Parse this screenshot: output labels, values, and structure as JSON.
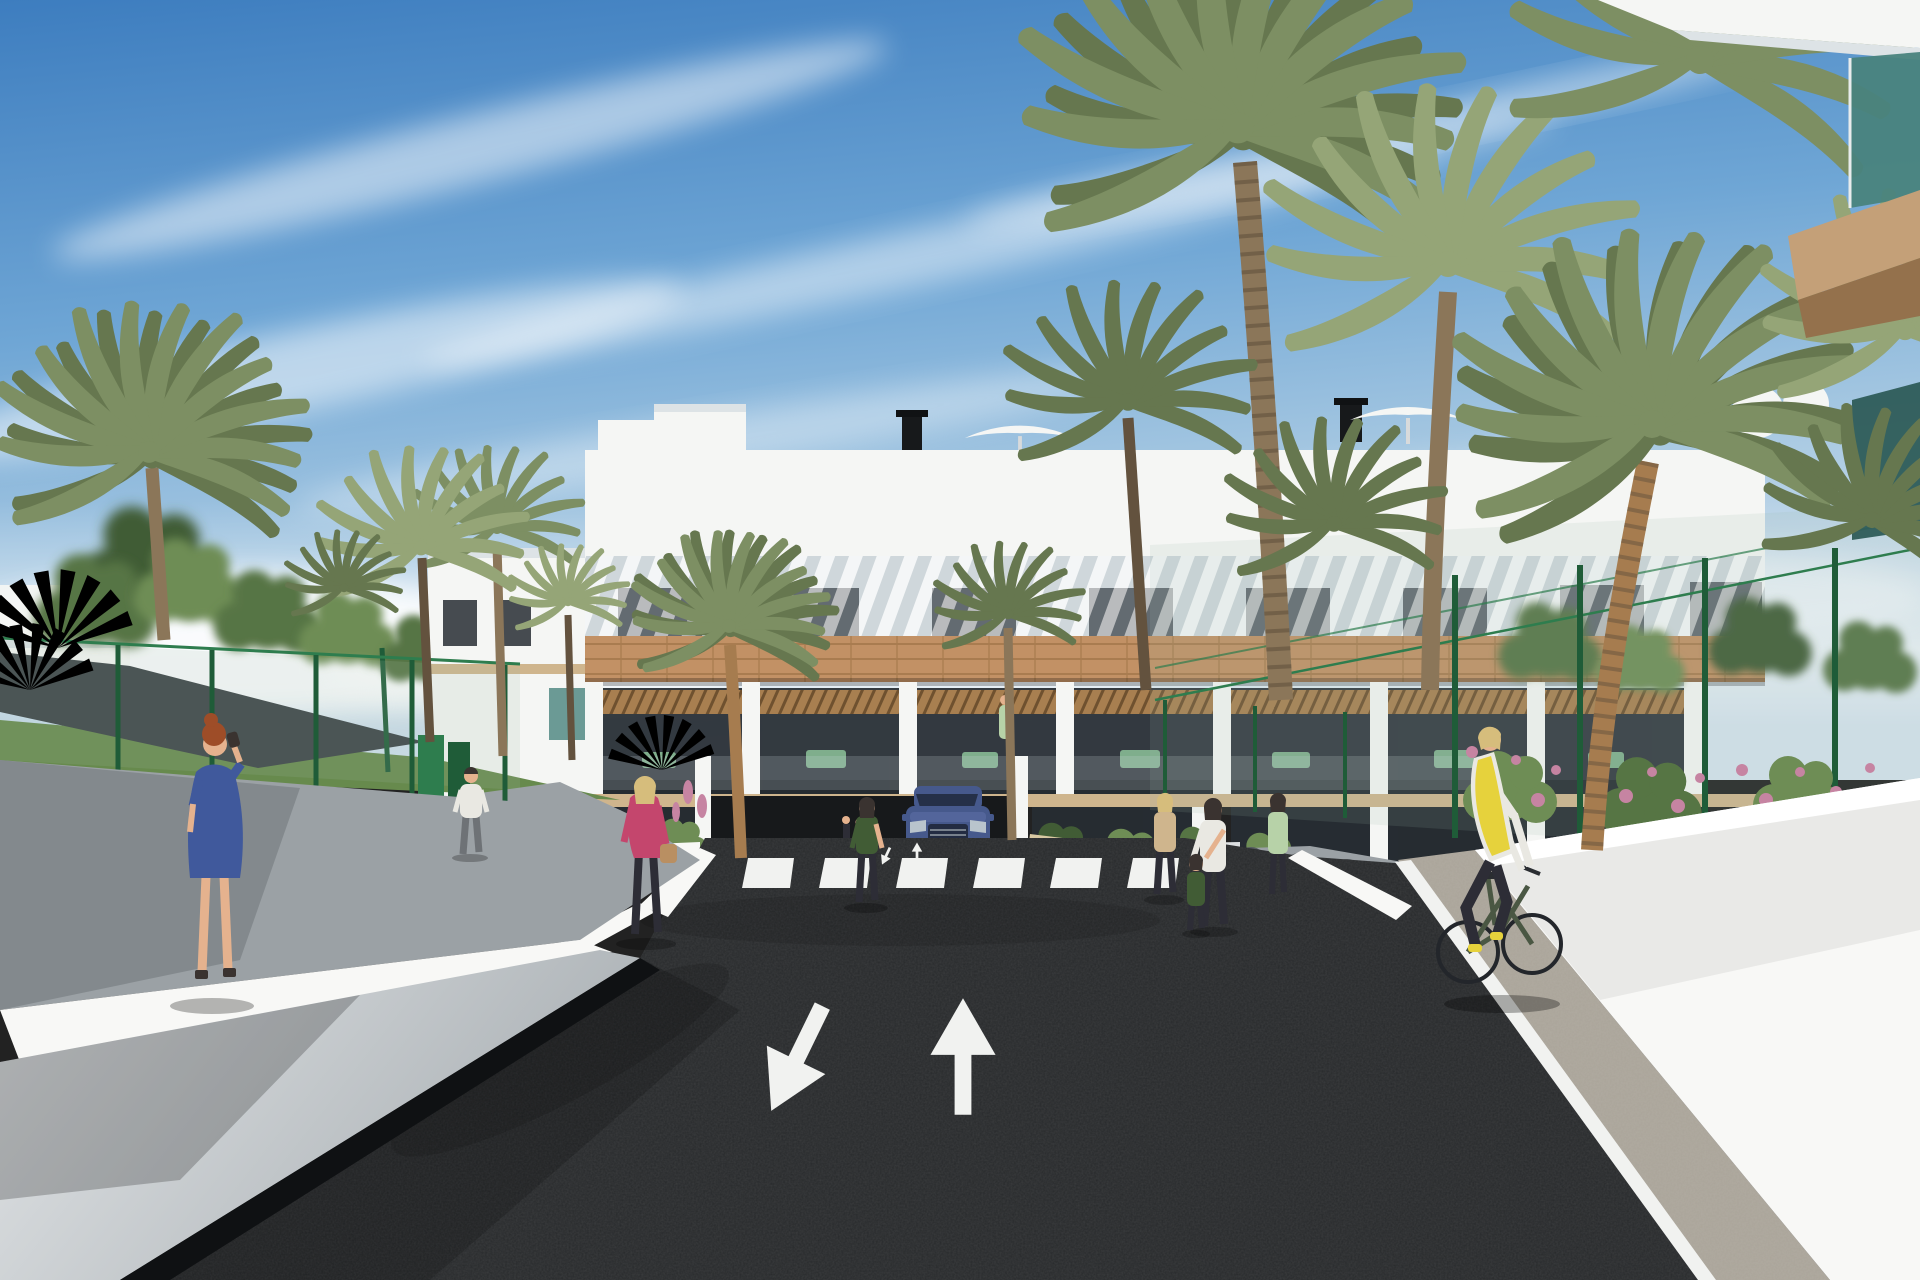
{
  "scene": {
    "type": "architectural-render",
    "description": "Sunny 3D visualization of a modern white Mediterranean apartment complex with palm trees, a two-lane asphalt access road with painted arrows and a zebra crosswalk, pedestrians, a cyclist and a blue SUV at the garage entrance.",
    "weather": "clear blue sky with wispy cirrus clouds",
    "objects": [
      {
        "name": "apartment-building",
        "description": "3-storey white block: louvred top loggia, dark glazing, tan brick band, wood-pergola terraces with green patio furniture"
      },
      {
        "name": "roof-items",
        "description": "white stepped volumes, black chimneys, white parasols and round tanks on the roof terraces"
      },
      {
        "name": "foreground-balcony-corner",
        "description": "near building corner top-right with teal glass balustrade and tan soffit"
      },
      {
        "name": "palm-trees",
        "description": "tall date palms left, centre and large cluster on the right"
      },
      {
        "name": "leafy-trees",
        "description": "green broadleaf trees behind the left fence and right hedge"
      },
      {
        "name": "shade-sail",
        "description": "dark grey shade canopy over the left walkway"
      },
      {
        "name": "green-mesh-fence",
        "description": "green wire fence panels both sides, tall sports-court fence on the right"
      },
      {
        "name": "flowers",
        "description": "pink flowering shrubs along the right fence, orange flowers in the entrance planters"
      },
      {
        "name": "asphalt-road",
        "description": "dark asphalt carriageway with white lane arrows (one up, one down-left) and a 6-stripe zebra crossing"
      },
      {
        "name": "white-retaining-walls",
        "description": "white ramp walls flanking the road on both sides"
      },
      {
        "name": "paver-path",
        "description": "grey paver cycle path on the right with white edge line"
      },
      {
        "name": "car",
        "description": "blue SUV, front view, waiting at the garage entrance"
      },
      {
        "name": "woman-blue-dress",
        "description": "red-haired woman in a blue dress walking on the left sidewalk, phone to ear"
      },
      {
        "name": "man-white-tshirt",
        "description": "man in white t-shirt on the rear left path"
      },
      {
        "name": "woman-pink-jacket",
        "description": "blonde woman in a pink jacket with tan handbag near the crossing"
      },
      {
        "name": "woman-near-car",
        "description": "dark-haired woman standing by the entrance planter"
      },
      {
        "name": "pedestrian-group",
        "description": "small group with child and bicycles at the racks right of the entrance"
      },
      {
        "name": "cyclist",
        "description": "blonde cyclist in yellow vest riding a dark green bike on the right path"
      },
      {
        "name": "bike-racks",
        "description": "metal hoop bike racks on the right walkway"
      }
    ]
  },
  "road_markings": {
    "crosswalk_stripes": 6,
    "lane_arrows": [
      "down-left",
      "up"
    ],
    "edge_lines": "white"
  },
  "colors": {
    "sky_top": "#3d7dbf",
    "sky_mid": "#6fa6d5",
    "sky_low": "#a8c9e2",
    "sky_horizon": "#d5e3ee",
    "cloud": "#ffffff",
    "bldg_white": "#f5f6f4",
    "bldg_shade": "#dde3e6",
    "window_dark": "#272d33",
    "brick": "#c29165",
    "brick_line": "#9e7347",
    "wood": "#a87f50",
    "wood_dark": "#6f512f",
    "soffit": "#cfb58d",
    "glass_teal": "#49837d",
    "glass_teal_dark": "#2e5c58",
    "tan_fascia": "#c4a078",
    "tan_dark": "#94714c",
    "fence_green": "#2e7d4e",
    "fence_dark": "#1f5c38",
    "mesh": "#9fb8a8",
    "foliage_dark": "#415c35",
    "foliage": "#567544",
    "foliage_light": "#6e8d55",
    "palm_dark": "#66774f",
    "palm": "#7d8f63",
    "palm_light": "#95a577",
    "trunk": "#8b7659",
    "trunk_dark": "#63523e",
    "trunk_warm": "#a67c4f",
    "grass": "#678a4d",
    "road": "#27292b",
    "road_shadow": "#17191b",
    "marking": "#f1f2f0",
    "wall_white": "#f8f8f6",
    "wall_light": "#dcdfe1",
    "wall_gray": "#b9bec1",
    "curb_dark": "#0f1113",
    "sidewalk": "#9ba1a5",
    "sidewalk_shade": "#70767a",
    "paver": "#aaa499",
    "sail": "#3b4246",
    "car_blue": "#46598c",
    "car_light": "#53659b",
    "car_dark": "#232c42",
    "grille": "#959da4",
    "headlight": "#b9c4cc",
    "flower_pink": "#c684a2",
    "flower_orange": "#d07c38",
    "sign": "#d8c8a2",
    "skin": "#e5b28e",
    "hair_red": "#9e4d28",
    "hair_blonde": "#d6bd7c",
    "hair_dark": "#3a3330",
    "dress_blue": "#40599c",
    "jacket_pink": "#c4466d",
    "vest_yellow": "#e6d23c",
    "clothes_dark": "#2d2d36",
    "shirt_white": "#e9e8e2",
    "bike_frame": "#4a5743",
    "figure_green": "#b7d2a8",
    "bag_tan": "#b98f62",
    "rack_gray": "#565c61"
  }
}
